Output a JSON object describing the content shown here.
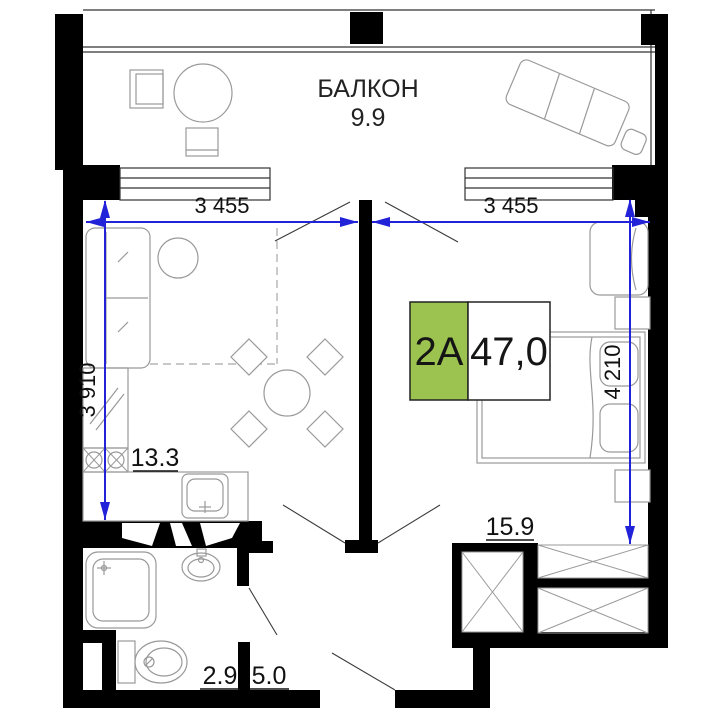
{
  "plan": {
    "balcony": {
      "label": "БАЛКОН",
      "area": "9.9"
    },
    "unit_badge": {
      "unit": "2A",
      "total_area": "47,0"
    },
    "room_areas": {
      "kitchen_living": "13.3",
      "bedroom": "15.9",
      "bathroom": "2.9",
      "hallway": "5.0"
    },
    "dimensions": {
      "living_width": "3 455",
      "bedroom_width": "3 455",
      "living_depth": "3 910",
      "bedroom_depth": "4 210"
    },
    "colors": {
      "wall": "#000000",
      "dimension_blue": "#2222d8",
      "badge_green": "#9cc34f",
      "furniture_gray": "#999999"
    }
  }
}
